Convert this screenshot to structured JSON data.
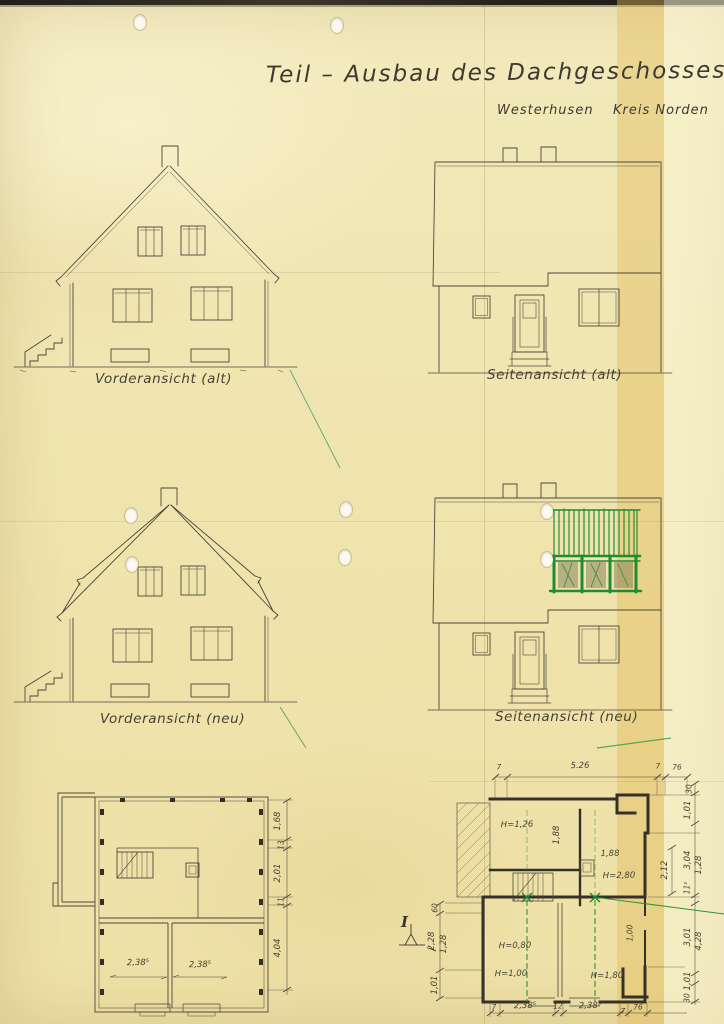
{
  "page": {
    "title": "Teil – Ausbau des Dachgeschosses",
    "location": "Westerhusen",
    "district": "Kreis Norden"
  },
  "figures": {
    "front_old": "Vorderansicht (alt)",
    "side_old": "Seitenansicht (alt)",
    "front_new": "Vorderansicht (neu)",
    "side_new": "Seitenansicht (neu)"
  },
  "plan_left": {
    "room_dim_1": "2,38⁵",
    "room_dim_2": "2,38⁵",
    "chain_right": [
      "1,68",
      "13",
      "2,01",
      "11",
      "4,04"
    ]
  },
  "plan_right": {
    "chain_top": [
      "7",
      "5.26",
      "7",
      "76"
    ],
    "chain_bottom": [
      "7",
      "2,38⁵",
      "12",
      "2,38⁵",
      "7",
      "76"
    ],
    "chain_left": [
      "60",
      "2,28",
      "1,28",
      "1,01"
    ],
    "chain_right_outer": [
      "30",
      "1,01",
      "3,04",
      "1,28",
      "11⁵",
      "3,01",
      "4,28",
      "1,01",
      "30"
    ],
    "chain_right_inner": "2,12",
    "heights": {
      "room_tl": "H=1,26",
      "mid": "1,88",
      "mid2": "1,88",
      "tr": "H=2,80",
      "bl": "H=0,80",
      "bl2": "H=1,00",
      "br_small": "1,00",
      "br": "H=1,80"
    },
    "section_marker": "I"
  },
  "colors": {
    "paper": "#efe5ae",
    "ink": "#49423a",
    "green_annotation": "#1f8c33",
    "aged_band": "#e6cf86"
  }
}
